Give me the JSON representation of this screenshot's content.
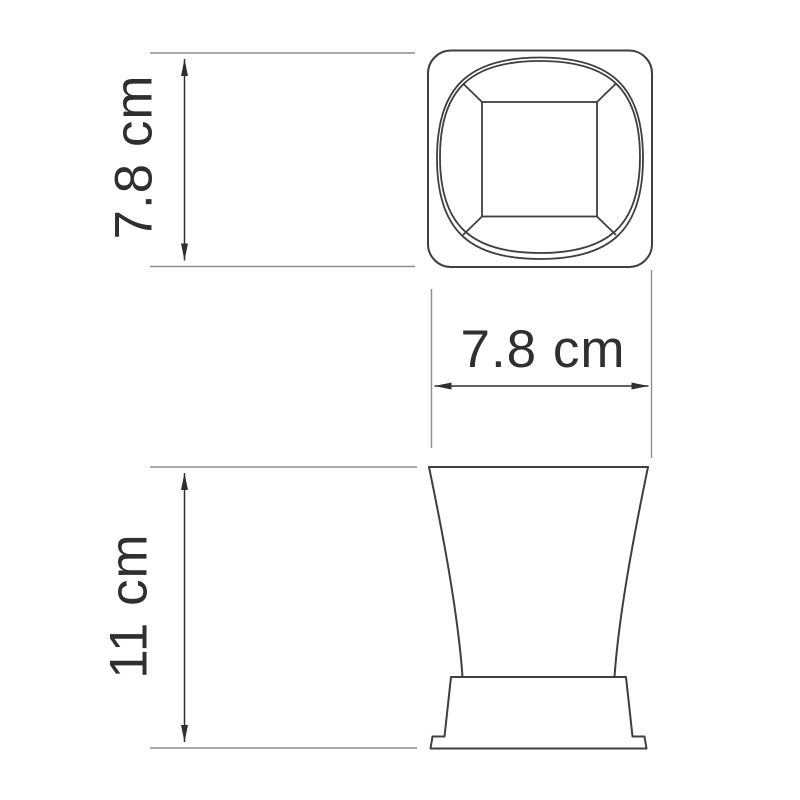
{
  "drawing": {
    "title": "tumbler-dimension-drawing",
    "labels": {
      "top_view_size": "7.8 cm",
      "rim_width": "7.8 cm",
      "body_height": "11 cm"
    },
    "colors": {
      "background": "#ffffff",
      "object_line": "#3f3f3f",
      "dimension_line": "#2f2f2f",
      "extension_line": "#8f8f8f",
      "label_text": "#2f2f2f"
    }
  }
}
